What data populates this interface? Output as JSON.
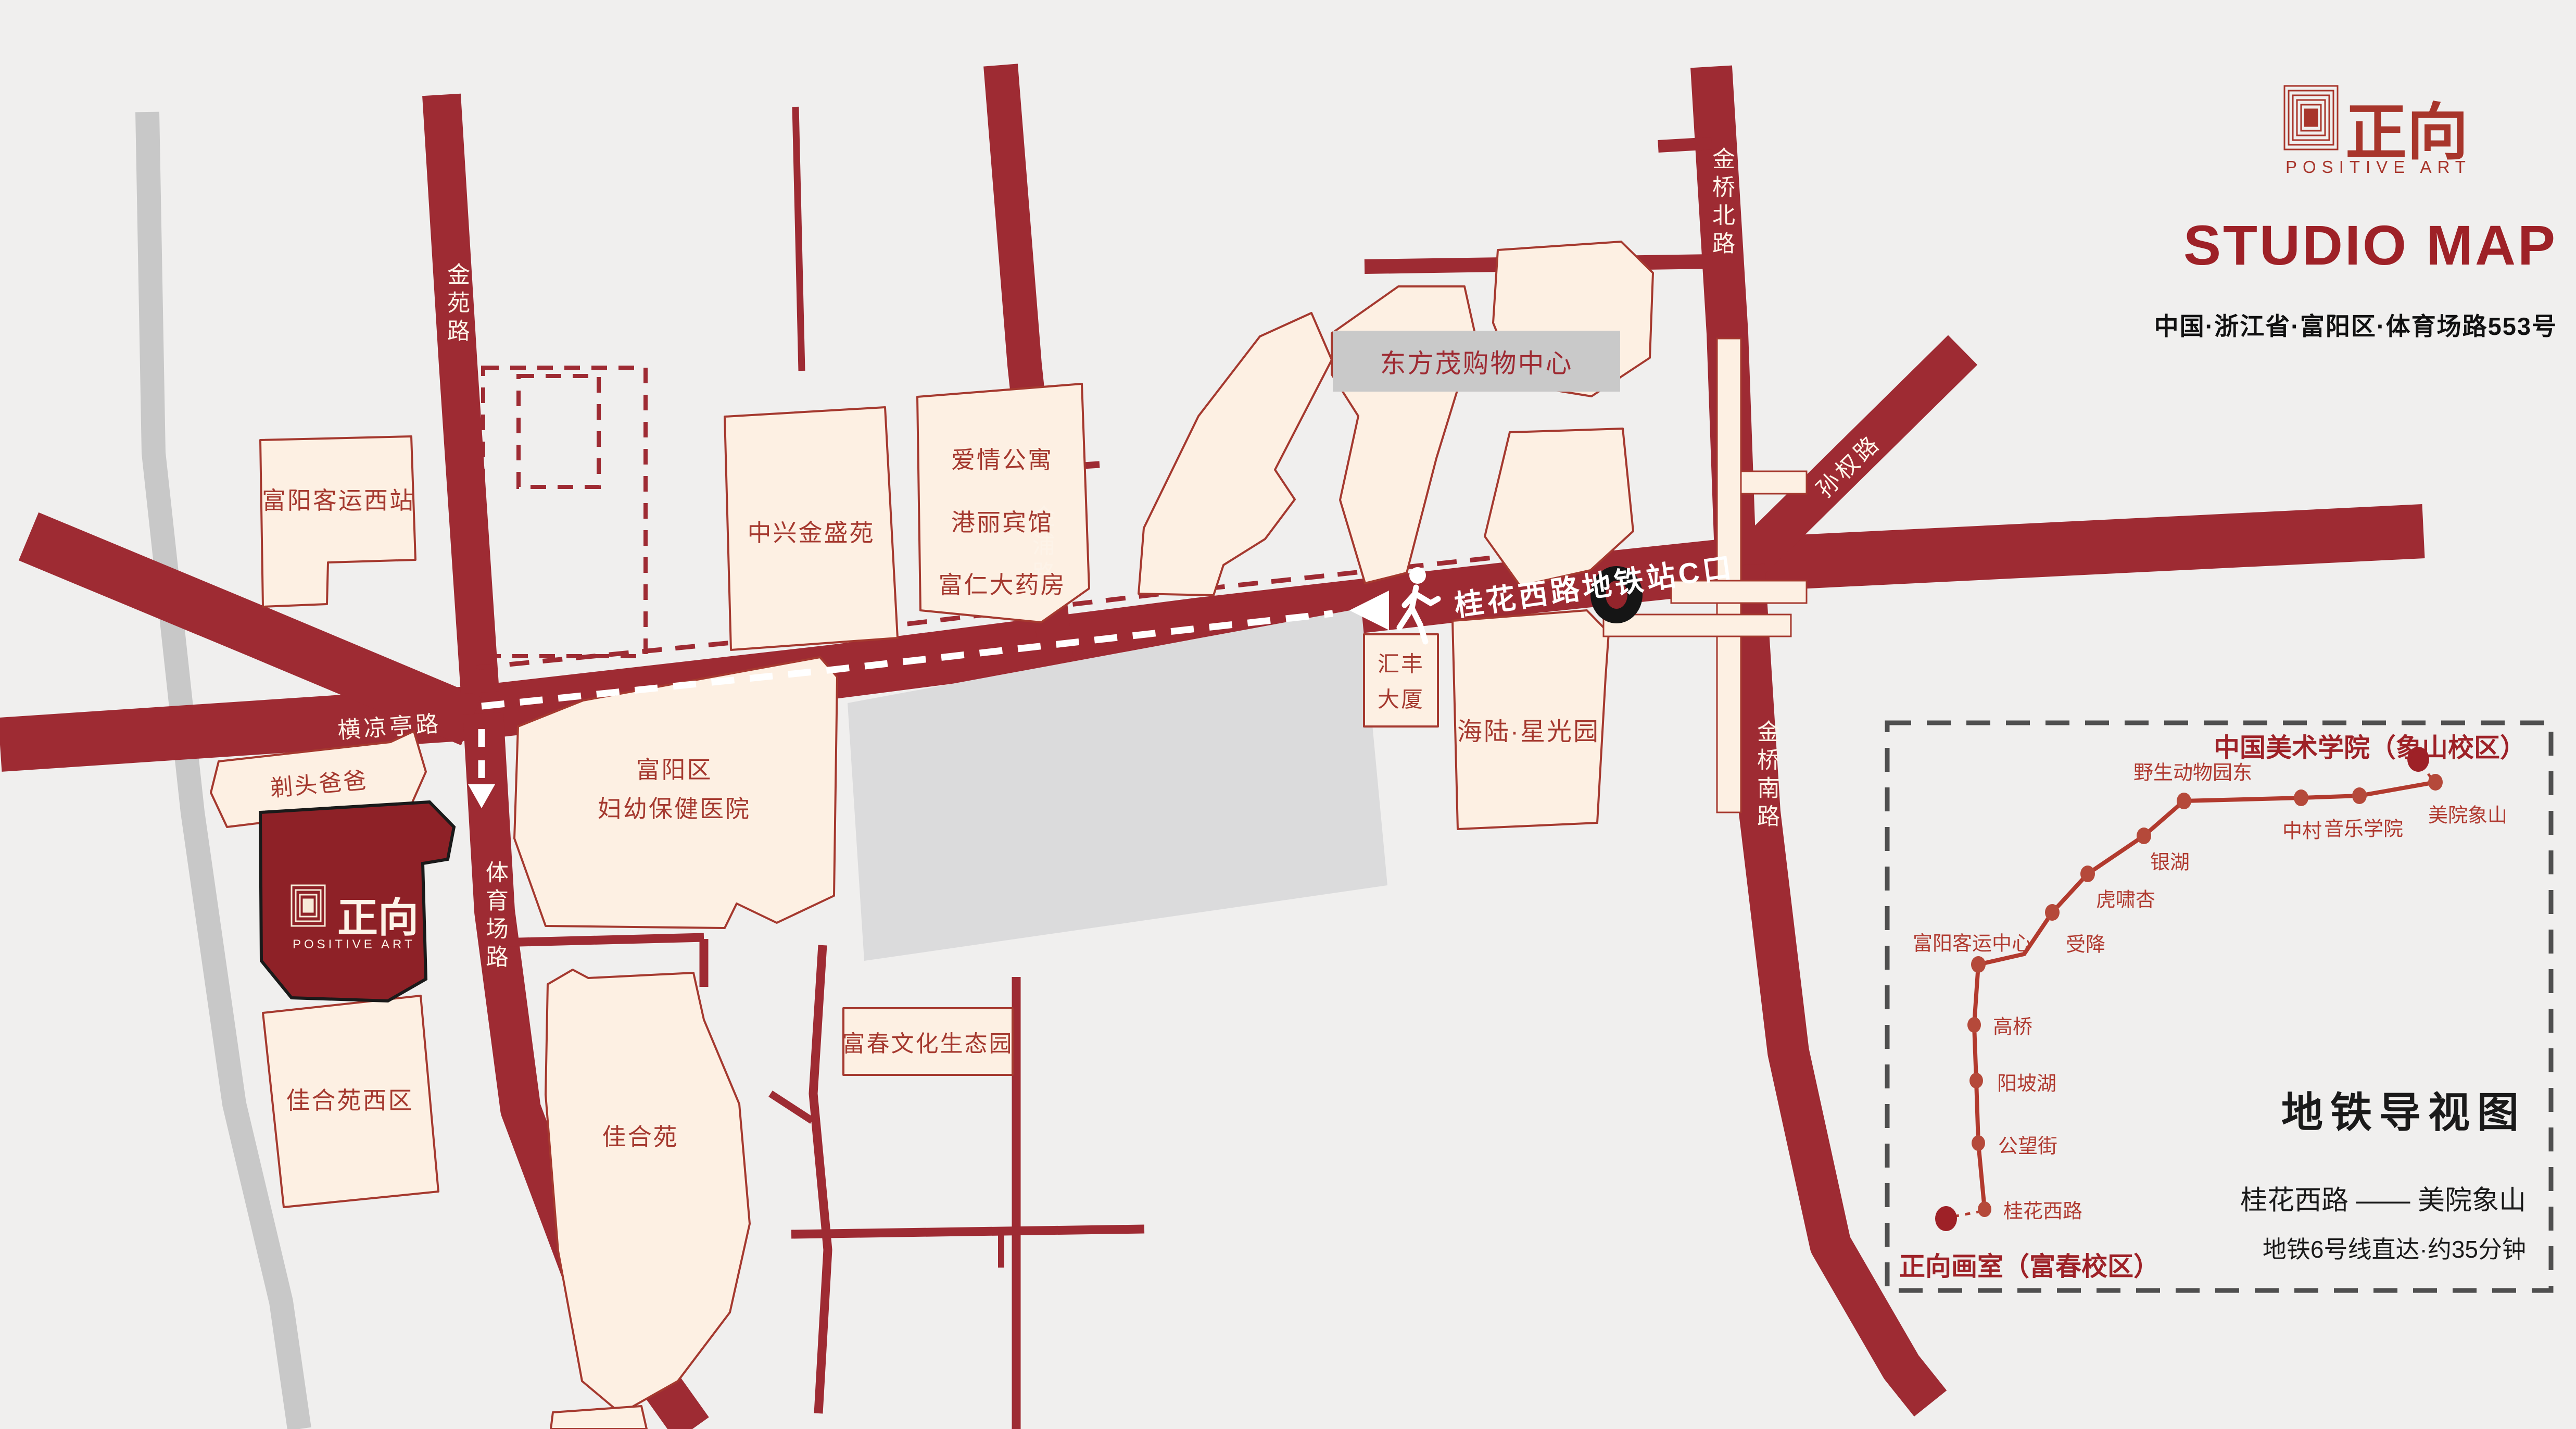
{
  "header": {
    "brand_cn": "正向",
    "brand_en": "POSITIVE ART",
    "title": "STUDIO MAP",
    "address": "中国·浙江省·富阳区·体育场路553号"
  },
  "map": {
    "road_labels": {
      "jinyuan": "金苑路",
      "jinpu": "金浦路",
      "jinqiao_north": "金桥北路",
      "sunquan": "孙权路",
      "jinqiao_south": "金桥南路",
      "tiyuchang": "体育场路",
      "hengliangting": "横凉亭路"
    },
    "route_label": "桂花西路地铁站C口",
    "buildings": {
      "west_station": "富阳客运西站",
      "zhongxing": "中兴金盛苑",
      "aiqing": "爱情公寓",
      "gangli": "港丽宾馆",
      "furen": "富仁大药房",
      "dongfangmao": "东方茂购物中心",
      "huifeng_l1": "汇丰",
      "huifeng_l2": "大厦",
      "hailu": "海陆·星光园",
      "titou": "剃头爸爸",
      "hospital_l1": "富阳区",
      "hospital_l2": "妇幼保健医院",
      "jiahe_west": "佳合苑西区",
      "jiahe": "佳合苑",
      "fuchun": "富春文化生态园"
    },
    "studio": {
      "brand_cn": "正向",
      "brand_en": "POSITIVE ART"
    }
  },
  "metro": {
    "title": "地铁导视图",
    "origin": "正向画室（富春校区）",
    "destination": "中国美术学院（象山校区）",
    "route": "桂花西路 —— 美院象山",
    "note": "地铁6号线直达·约35分钟",
    "stations": [
      "桂花西路",
      "公望街",
      "阳坡湖",
      "高桥",
      "富阳客运中心",
      "受降",
      "虎啸杏",
      "银湖",
      "野生动物园东",
      "中村",
      "音乐学院",
      "美院象山"
    ]
  },
  "colors": {
    "road_red": "#9e2b33",
    "building_fill": "#fdf0e3",
    "building_stroke": "#a5392f",
    "studio_red": "#8e2127",
    "logo_red": "#a8352b",
    "metro_line": "#b23a2e",
    "background": "#f0efee"
  }
}
